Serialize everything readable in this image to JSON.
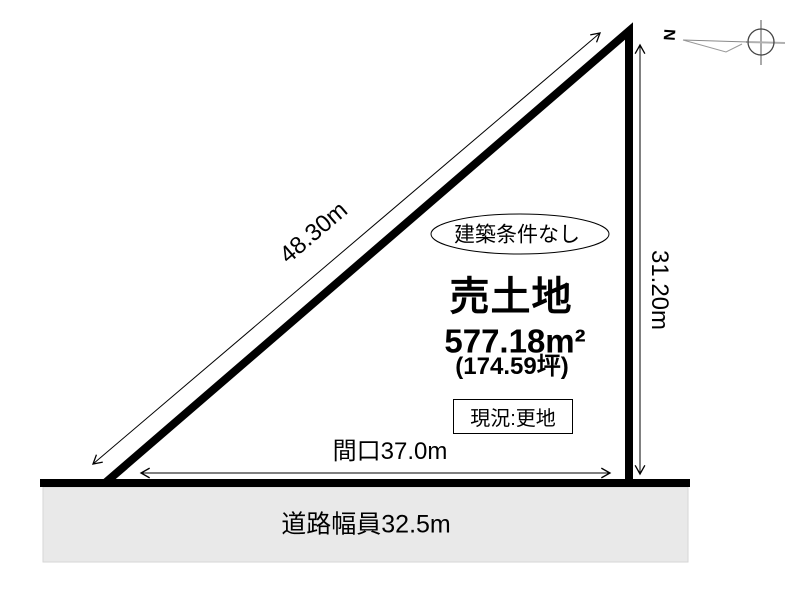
{
  "diagram": {
    "title": "売土地",
    "area_sqm": "577.18m²",
    "area_tsubo": "(174.59坪)",
    "condition_badge": "建築条件なし",
    "status_box": "現況:更地",
    "frontage_dim": "間口37.0m",
    "road_label": "道路幅員32.5m",
    "hypotenuse_dim": "48.30m",
    "right_side_dim": "31.20m",
    "compass_north": "N"
  },
  "colors": {
    "line": "#000000",
    "road_fill": "#e9e9e9",
    "background": "#ffffff"
  }
}
